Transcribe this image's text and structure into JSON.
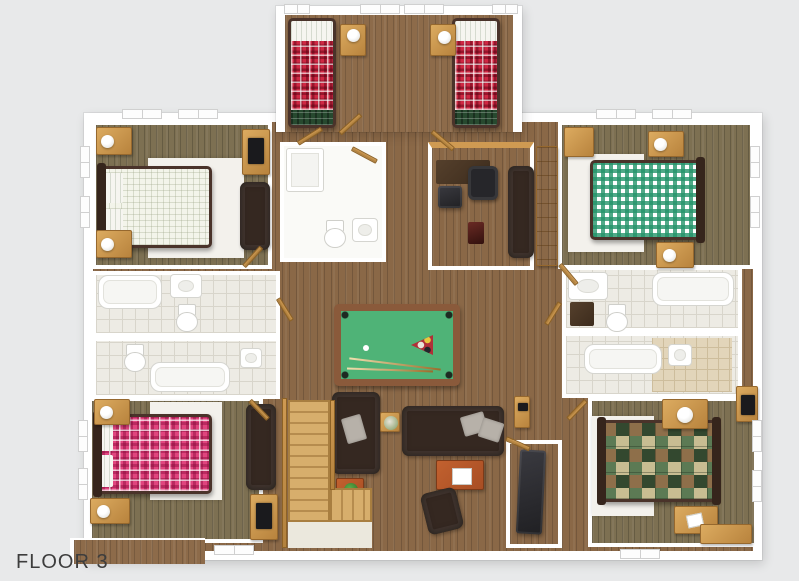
{
  "page": {
    "title": "FLOOR 3"
  },
  "palette": {
    "background": "#e8e9ea",
    "wall": "#ffffff",
    "wood_trim": "#cf9a52",
    "floor_hall": "#8a6847",
    "floor_bunk": "#8d6b4a",
    "floor_bedroom": "#7d7052",
    "tile": "#edebe4",
    "tile_line": "#d8d5cb",
    "rug": "#f3f1ec",
    "bed_frame": "#4a332a",
    "plaid_red": "#cf2843",
    "plaid_pink": "#e0457e",
    "gingham_green": "#24946a",
    "quilt_green": "#5c7a54",
    "pool_felt": "#4fb377",
    "pool_rail": "#8a5a3b",
    "sofa": "#352821",
    "pillow_gray": "#b7b1a9",
    "table_orange": "#a84e24",
    "stair_wood": "#d7ae6c",
    "label_color": "#3d3d3d"
  },
  "scene": {
    "type": "3d-floor-plan-render",
    "floor_label": "FLOOR 3",
    "rooms": [
      {
        "id": "bunk-bedroom-top",
        "furniture": [
          "twin-bed-red-plaid",
          "twin-bed-red-plaid",
          "nightstand",
          "nightstand",
          "window",
          "window"
        ]
      },
      {
        "id": "bedroom-top-left",
        "furniture": [
          "double-bed-cream-check",
          "nightstand",
          "nightstand",
          "dresser-tv",
          "bench-sofa",
          "rug"
        ]
      },
      {
        "id": "bedroom-top-right",
        "furniture": [
          "double-bed-green-gingham",
          "nightstand",
          "nightstand",
          "wardrobe",
          "rug"
        ]
      },
      {
        "id": "bathroom-center",
        "furniture": [
          "shower",
          "toilet",
          "sink"
        ]
      },
      {
        "id": "study-nook",
        "furniture": [
          "desk",
          "office-chair",
          "cube-seat",
          "speaker",
          "sofa"
        ]
      },
      {
        "id": "bathroom-left-upper",
        "furniture": [
          "bathtub",
          "sink",
          "toilet"
        ]
      },
      {
        "id": "bathroom-left-lower",
        "furniture": [
          "toilet",
          "bathtub",
          "sink"
        ]
      },
      {
        "id": "bathroom-right-upper",
        "furniture": [
          "sink-counter",
          "vanity",
          "bathtub",
          "toilet"
        ]
      },
      {
        "id": "bathroom-right-lower",
        "furniture": [
          "bathtub",
          "sink"
        ]
      },
      {
        "id": "hallway-game-room",
        "furniture": [
          "pool-table",
          "sofa-vertical",
          "sofa-horizontal",
          "coffee-table",
          "armchair",
          "plant-table",
          "flower-table",
          "wall-cabinet",
          "staircase"
        ]
      },
      {
        "id": "bedroom-bottom-left",
        "furniture": [
          "double-bed-pink-plaid",
          "nightstand",
          "nightstand",
          "bench-sofa",
          "dresser-tv",
          "rug"
        ]
      },
      {
        "id": "bedroom-bottom-right",
        "furniture": [
          "double-bed-lodge-quilt",
          "nightstand",
          "nightstand",
          "desk",
          "rug"
        ]
      },
      {
        "id": "closet-bottom-center",
        "furniture": [
          "dark-equipment"
        ]
      }
    ]
  }
}
